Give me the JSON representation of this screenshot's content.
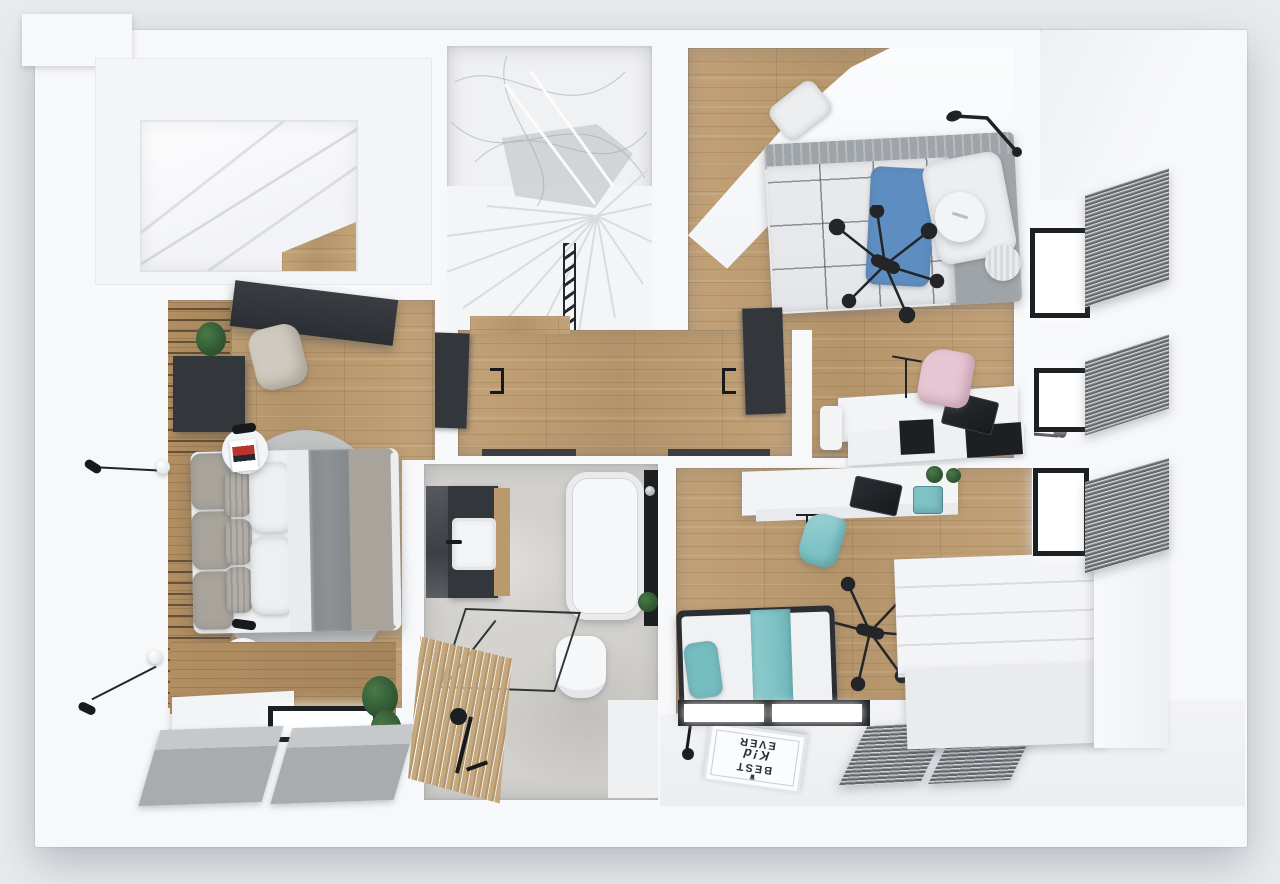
{
  "meta": {
    "kind": "3d-floor-plan-render",
    "view": "top-down dollhouse",
    "visible_text": "BEST K!d EVER rug (rotated 180 degrees)"
  },
  "colors": {
    "background": "#e8eaed",
    "wall": "#f7f8fa",
    "wood_floor": "#c3a278",
    "wood_dark_band": "#b28e62",
    "bath_floor": "#d2d0cc",
    "stair_floor": "#f0f1f3",
    "dark_furniture": "#33373c",
    "near_black": "#1d2023",
    "teal": "#7fc3c6",
    "blue_pillow": "#5e8ec1",
    "pink_chair": "#e6c6d3",
    "duvet_taupe": "#a8a49c",
    "throw_gray": "#8e9295",
    "bed_gray": "#9fa4a9",
    "rug_gray": "#c2c5c8",
    "mat_gray": "#a9acae",
    "blind_dark": "#63666a",
    "blind_light": "#d2d4d7",
    "white_furniture": "#f3f4f6",
    "plant_green": "#2c5230",
    "accent_red": "#b8342c"
  },
  "rug": {
    "glyph": "♛",
    "line1": "BEST",
    "line2": "K!d",
    "line3": "EVER"
  },
  "rooms": {
    "walk_in_closet": {
      "contents": [
        "white wardrobes",
        "wood floor patch"
      ]
    },
    "stairwell": {
      "contents": [
        "winder stairs",
        "black railing",
        "wire ceiling decor"
      ]
    },
    "bedroom_top_right": {
      "contents": [
        "single bed with plaid duvet",
        "blue pillow",
        "white pillow",
        "gray headboard",
        "round side table",
        "woven basket",
        "spider ceiling lamp",
        "black wall lamp",
        "white desk",
        "laptop",
        "pink chair",
        "white ottoman",
        "two windows with exterior blinds"
      ]
    },
    "hallway": {
      "contents": [
        "wood floor",
        "two dark open doors",
        "stair railing"
      ]
    },
    "master_bedroom": {
      "contents": [
        "double bed",
        "gray and white pillows",
        "gray throw",
        "oval rug",
        "two round side tables with posters",
        "two wall lamps",
        "dark wardrobe",
        "wall desk",
        "beige chair",
        "plant",
        "wood slat wall",
        "window",
        "folded gray mats"
      ]
    },
    "bathroom": {
      "contents": [
        "dark vanity with sink",
        "bathtub",
        "black fixture panel",
        "toilet",
        "glass shower",
        "wood slat mat",
        "black shower fixture",
        "plant"
      ]
    },
    "kids_bedroom": {
      "contents": [
        "single bed with teal runner",
        "teal pillow",
        "BEST K!d EVER rug",
        "black floor lamp",
        "white desk",
        "laptop",
        "teal chair",
        "plants",
        "spider ceiling lamp",
        "white dresser",
        "windows with exterior blinds",
        "striped mats"
      ]
    }
  }
}
